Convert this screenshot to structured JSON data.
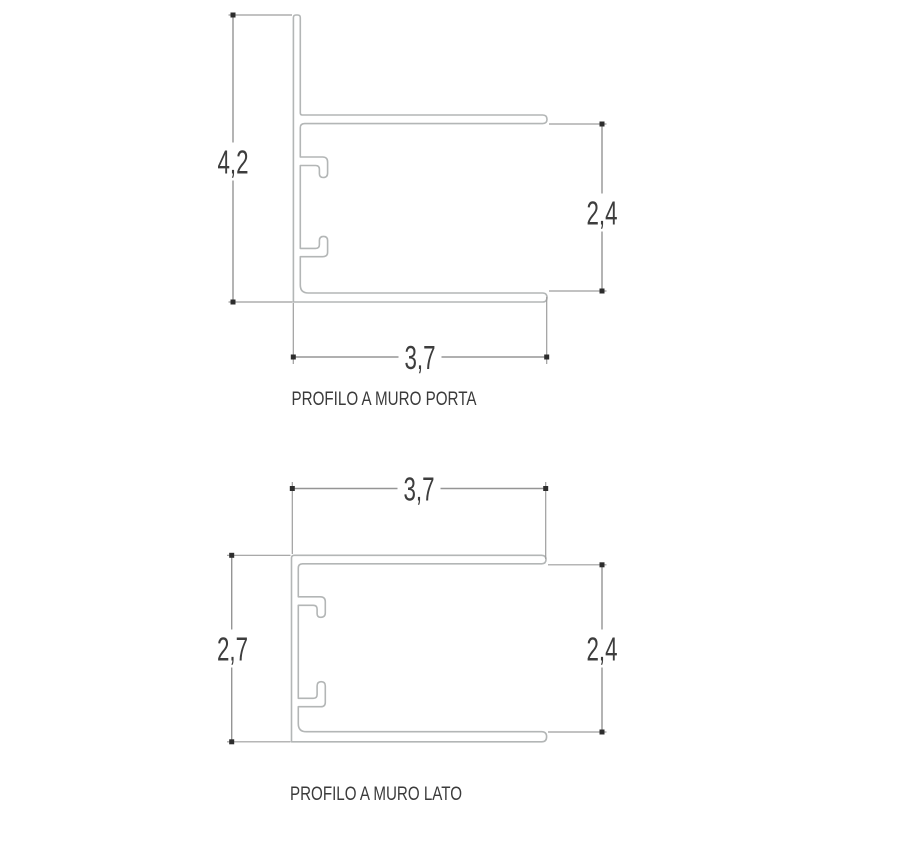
{
  "page": {
    "background": "#ffffff",
    "type": "technical-profile-drawing"
  },
  "colors": {
    "profile_stroke": "#b3b6b6",
    "dimension_stroke": "#959595",
    "marker": "#2d2d2d",
    "text": "#3d3d3d"
  },
  "drawings": [
    {
      "id": "porta",
      "caption": "PROFILO A MURO PORTA",
      "dimensions": [
        {
          "name": "overall-height",
          "value": "4,2"
        },
        {
          "name": "inner-height",
          "value": "2,4"
        },
        {
          "name": "overall-width",
          "value": "3,7"
        }
      ]
    },
    {
      "id": "lato",
      "caption": "PROFILO A MURO LATO",
      "dimensions": [
        {
          "name": "overall-width",
          "value": "3,7"
        },
        {
          "name": "overall-height",
          "value": "2,7"
        },
        {
          "name": "inner-height",
          "value": "2,4"
        }
      ]
    }
  ]
}
